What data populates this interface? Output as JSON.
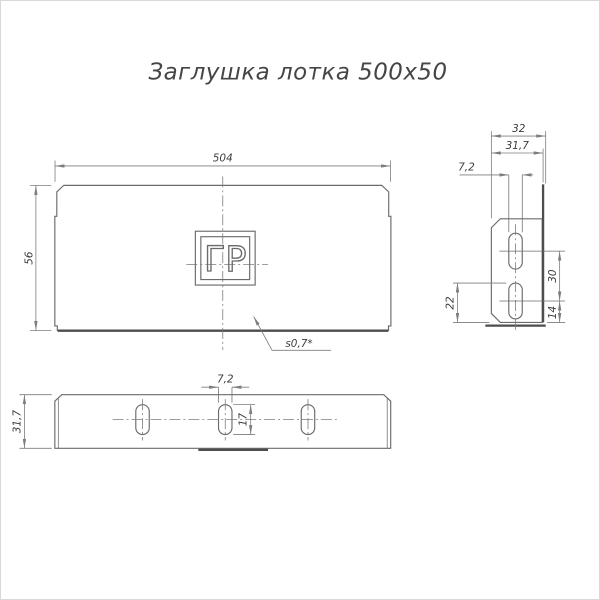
{
  "title": "Заглушка лотка 500х50",
  "front_view": {
    "width_dim": "504",
    "height_dim": "56",
    "thickness_note": "s0,7*",
    "logo_text": "ГР"
  },
  "side_view": {
    "depth_overall_dim": "32",
    "depth_inner_dim": "31,7",
    "slot_width_dim": "7,2",
    "slot_spacing_dim": "30",
    "slot_edge_dim": "22",
    "slot_bottom_offset_dim": "14"
  },
  "bottom_view": {
    "slot_width_dim": "7,2",
    "slot_length_dim": "17",
    "flange_depth_dim": "31,7"
  },
  "colors": {
    "line": "#6b6b6b",
    "thick": "#4d4d4d",
    "dim": "#7d7d7d",
    "text": "#3d3d3d",
    "background": "#ffffff",
    "frame": "#d9d9d9"
  }
}
